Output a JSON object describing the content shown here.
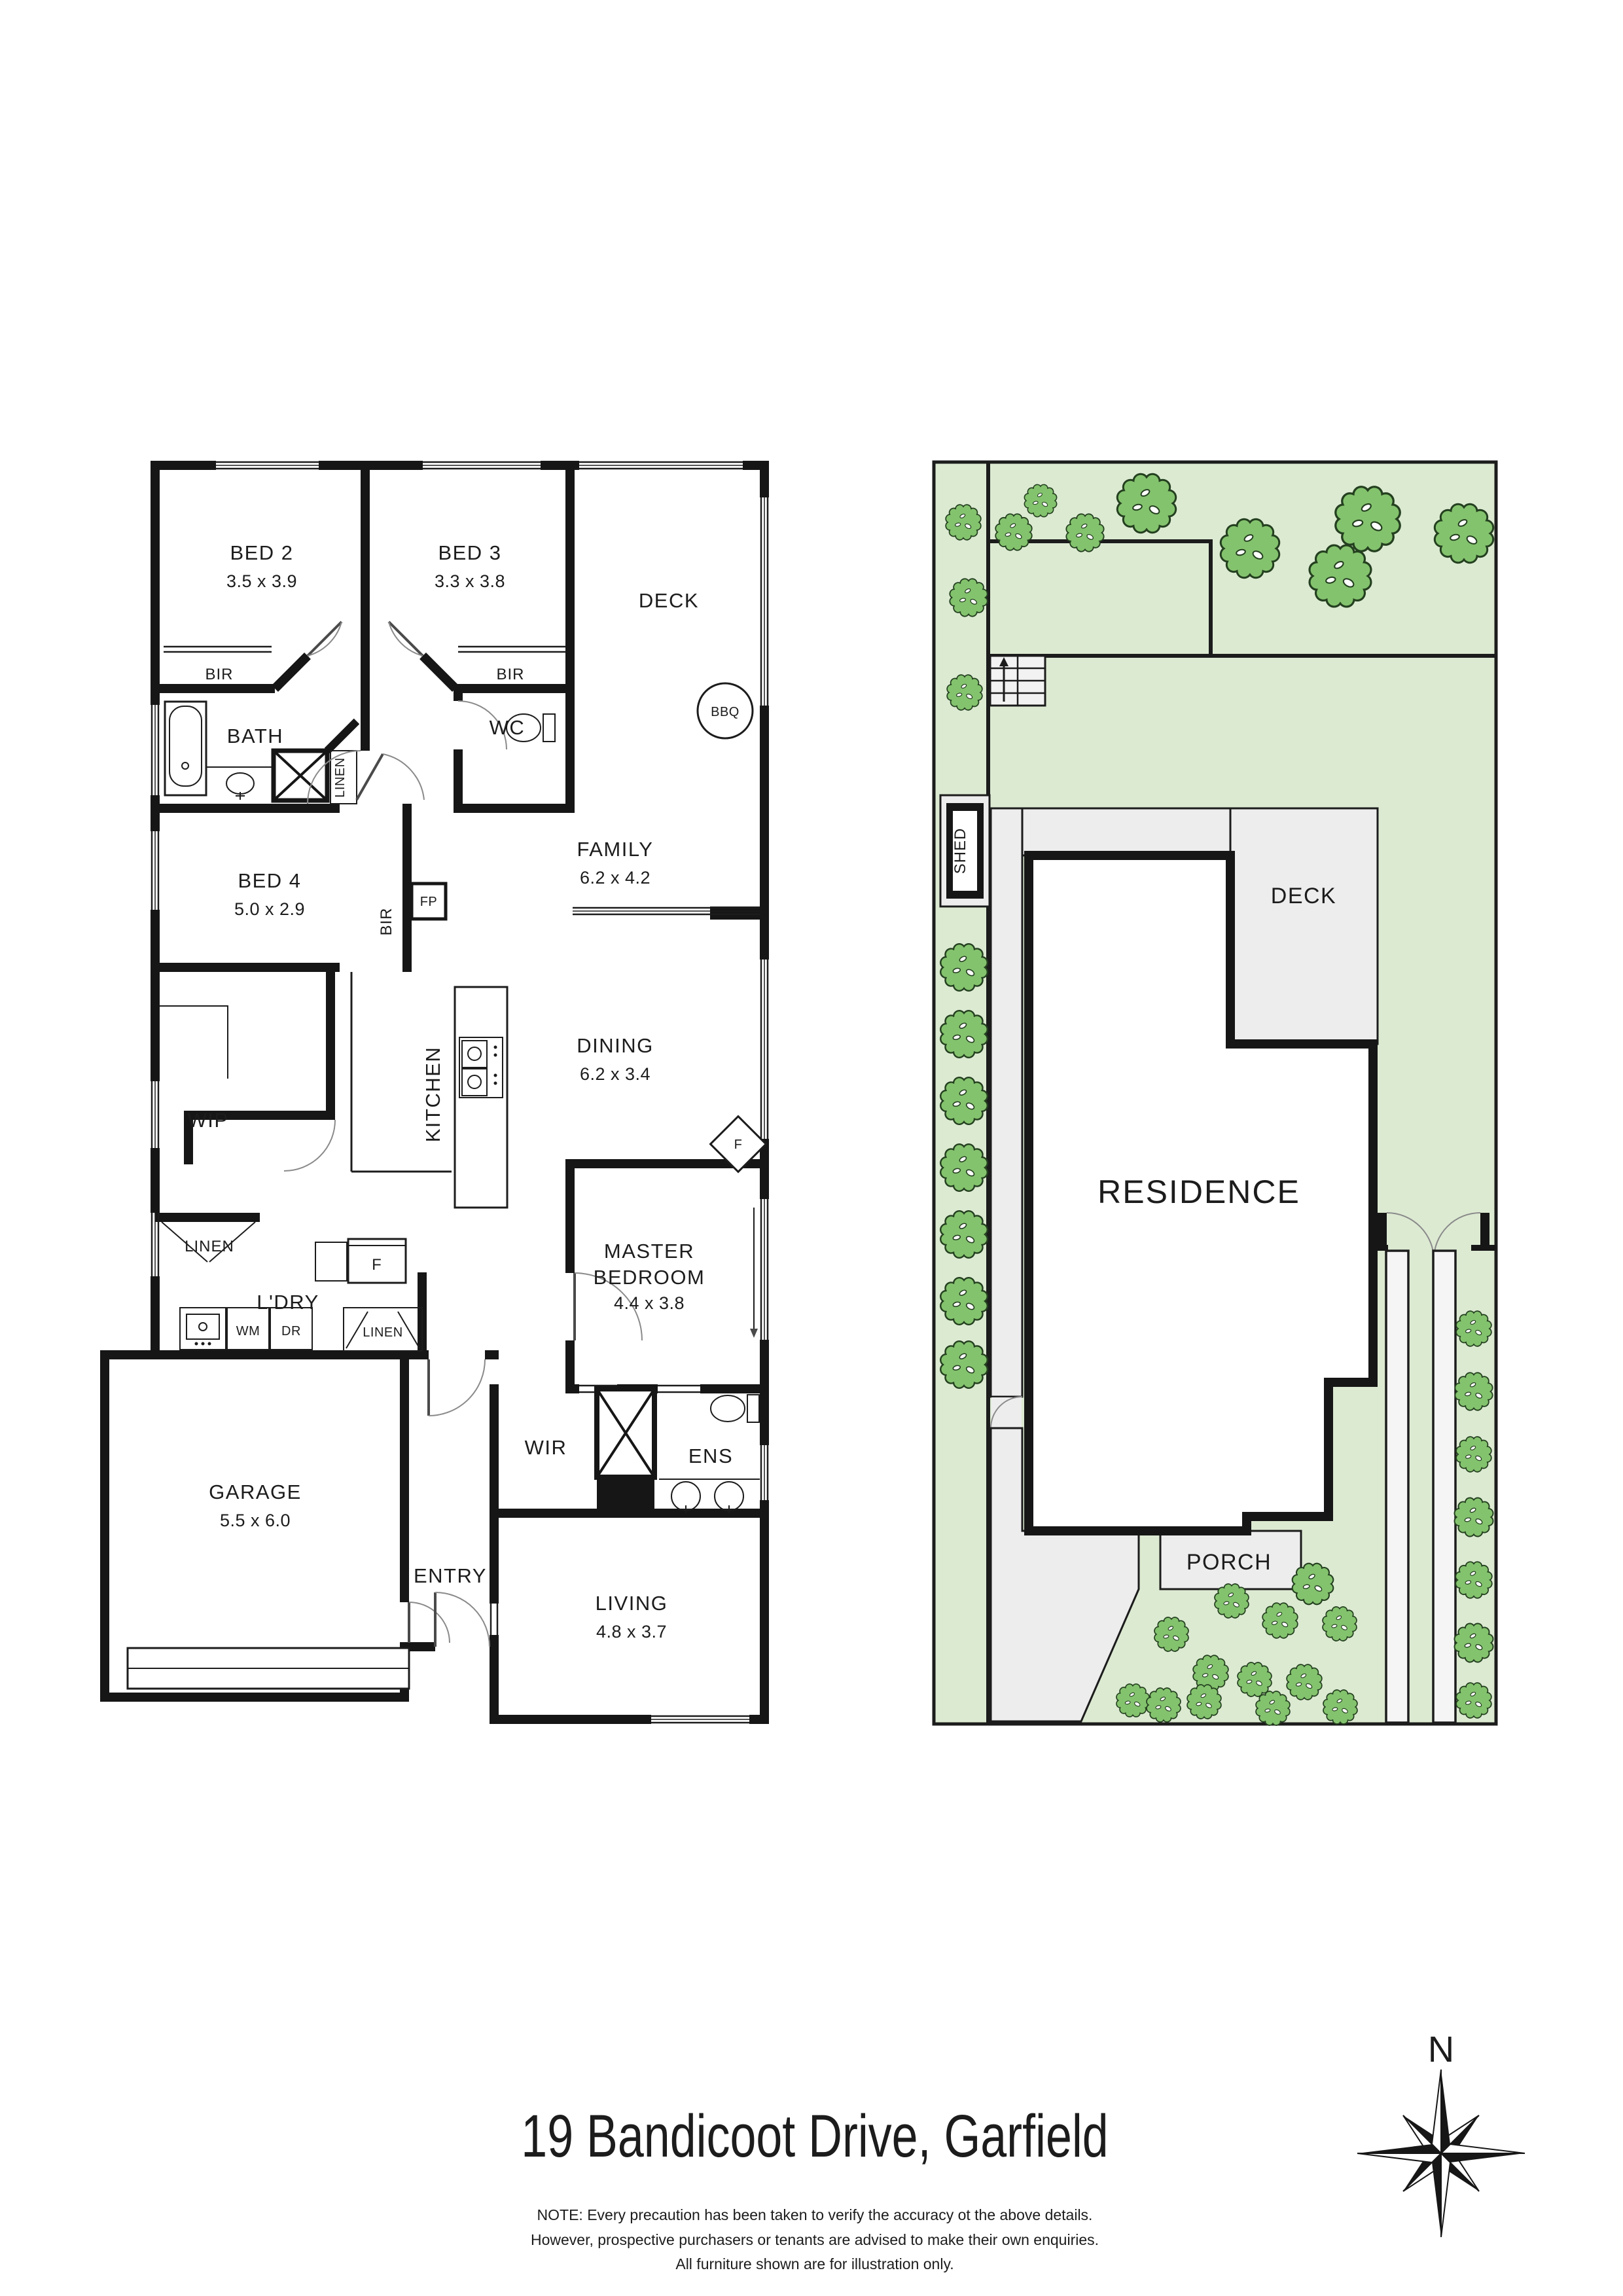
{
  "colors": {
    "wall": "#161616",
    "site_green": "#dcead2",
    "tree_fill": "#84c36e",
    "tree_stroke": "#24401f",
    "path_gray": "#ededed",
    "strip_white": "#f5f5f5"
  },
  "floorplan": {
    "bed2": {
      "name": "BED 2",
      "dims": "3.5 x 3.9"
    },
    "bed3": {
      "name": "BED 3",
      "dims": "3.3 x 3.8"
    },
    "bed4": {
      "name": "BED 4",
      "dims": "5.0 x 2.9"
    },
    "deck": "DECK",
    "bbq": "BBQ",
    "bath": "BATH",
    "wc": "WC",
    "bir": "BIR",
    "linen": "LINEN",
    "family": {
      "name": "FAMILY",
      "dims": "6.2 x 4.2"
    },
    "dining": {
      "name": "DINING",
      "dims": "6.2 x 3.4"
    },
    "kitchen": "KITCHEN",
    "wip": "WIP",
    "fp": "FP",
    "fridge": "F",
    "fan": "F",
    "ldry": "L'DRY",
    "wm": "WM",
    "dr": "DR",
    "master": {
      "line1": "MASTER",
      "line2": "BEDROOM",
      "dims": "4.4 x 3.8"
    },
    "garage": {
      "name": "GARAGE",
      "dims": "5.5 x 6.0"
    },
    "entry": "ENTRY",
    "wir": "WIR",
    "ens": "ENS",
    "living": {
      "name": "LIVING",
      "dims": "4.8 x 3.7"
    }
  },
  "siteplan": {
    "residence": "RESIDENCE",
    "deck": "DECK",
    "porch": "PORCH",
    "shed": "SHED",
    "trees": [
      [
        1549,
        813,
        0.62
      ],
      [
        1590,
        765,
        0.55
      ],
      [
        1658,
        814,
        0.64
      ],
      [
        1752,
        769,
        1.0
      ],
      [
        1910,
        838,
        1.0
      ],
      [
        2048,
        880,
        1.05
      ],
      [
        2090,
        793,
        1.1
      ],
      [
        2237,
        815,
        1.0
      ],
      [
        1472,
        798,
        0.6
      ],
      [
        1480,
        913,
        0.64
      ],
      [
        1474,
        1058,
        0.6
      ],
      [
        1473,
        1478,
        0.8
      ],
      [
        1473,
        1580,
        0.8
      ],
      [
        1473,
        1682,
        0.8
      ],
      [
        1473,
        1784,
        0.8
      ],
      [
        1473,
        1886,
        0.8
      ],
      [
        1473,
        1988,
        0.8
      ],
      [
        1473,
        2085,
        0.8
      ],
      [
        2252,
        2030,
        0.6
      ],
      [
        2252,
        2126,
        0.64
      ],
      [
        2252,
        2222,
        0.6
      ],
      [
        2252,
        2318,
        0.66
      ],
      [
        2252,
        2414,
        0.62
      ],
      [
        2252,
        2510,
        0.66
      ],
      [
        2252,
        2598,
        0.6
      ],
      [
        2006,
        2420,
        0.7
      ],
      [
        1882,
        2446,
        0.58
      ],
      [
        1956,
        2476,
        0.6
      ],
      [
        2047,
        2481,
        0.58
      ],
      [
        1790,
        2497,
        0.58
      ],
      [
        1850,
        2556,
        0.6
      ],
      [
        1917,
        2566,
        0.58
      ],
      [
        1993,
        2570,
        0.6
      ],
      [
        1731,
        2598,
        0.56
      ],
      [
        1778,
        2605,
        0.58
      ],
      [
        1840,
        2600,
        0.58
      ],
      [
        1945,
        2610,
        0.58
      ],
      [
        2048,
        2608,
        0.58
      ]
    ]
  },
  "footer": {
    "title": "19 Bandicoot Drive, Garfield",
    "compass": "N",
    "note1": "NOTE: Every precaution has been taken to verify the accuracy ot the above details.",
    "note2": "However, prospective purchasers or tenants are advised to make their own enquiries.",
    "note3": "All furniture shown are for illustration only."
  }
}
